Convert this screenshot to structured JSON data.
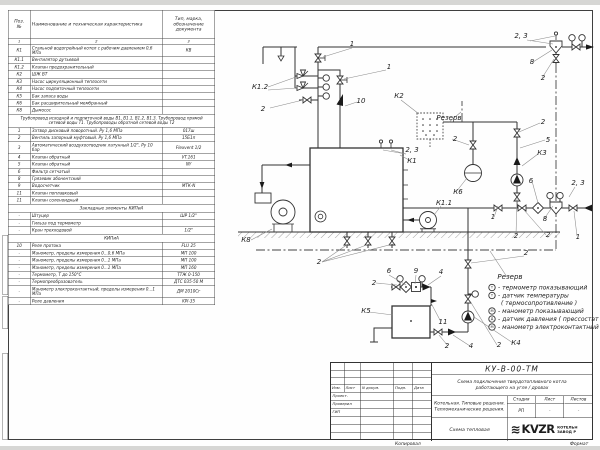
{
  "spec_table": {
    "headers": {
      "pos": "Поз.\n№",
      "name": "Наименование и техническая характеристика",
      "type": "Тип, марка, обозначение документа"
    },
    "col_nums": [
      "1",
      "2",
      "3"
    ],
    "rows": [
      {
        "pos": "К1",
        "name": "Стальной водогрейный котел с рабочим давлением 0,6 МПа",
        "type": "КВ"
      },
      {
        "pos": "К1.1",
        "name": "Вентилятор дутьевой",
        "type": ""
      },
      {
        "pos": "К1.2",
        "name": "Клапан предохранительный",
        "type": ""
      },
      {
        "pos": "К2",
        "name": "ШЖ ВТ",
        "type": ""
      },
      {
        "pos": "К3",
        "name": "Насос циркуляционный теплосети",
        "type": ""
      },
      {
        "pos": "К4",
        "name": "Насос подпиточный теплосети",
        "type": ""
      },
      {
        "pos": "К5",
        "name": "Бак запаса воды",
        "type": ""
      },
      {
        "pos": "К6",
        "name": "Бак расширительный мембранный",
        "type": ""
      },
      {
        "pos": "К8",
        "name": "Дымосос",
        "type": ""
      },
      {
        "span": "Трубопровод исходной и подпиточной воды В1, В1.1, В1.2, В1.3. Трубопровод прямой сетевой воды Т1. Трубопроводы обратной сетевой воды Т2"
      },
      {
        "pos": "1",
        "name": "Затвор дисковый поворотный. Ру 1,6 МПа",
        "type": "017ш"
      },
      {
        "pos": "2",
        "name": "Вентиль запорный муфтовый. Ру 1,6 МПа",
        "type": "15Б1п"
      },
      {
        "pos": "3",
        "name": "Автоматический воздухоотводчик латунный 1/2\", Ру 10 бар",
        "type": "Flexvent 1/2"
      },
      {
        "pos": "4",
        "name": "Клапан обратный",
        "type": "VT.161"
      },
      {
        "pos": "5",
        "name": "Клапан обратный",
        "type": "NY"
      },
      {
        "pos": "6",
        "name": "Фильтр сетчатый",
        "type": ""
      },
      {
        "pos": "8",
        "name": "Грязевик абонентский",
        "type": ""
      },
      {
        "pos": "9",
        "name": "Водосчетчик",
        "type": "МТК-N"
      },
      {
        "pos": "11",
        "name": "Клапан поплавковый",
        "type": ""
      },
      {
        "pos": "11",
        "name": "Клапан соленоидный",
        "type": ""
      },
      {
        "section": "Закладные элементы КИПиА"
      },
      {
        "pos": "-",
        "name": "Штуцер",
        "type": "ШР 1/2\""
      },
      {
        "pos": "-",
        "name": "Гильза под термометр",
        "type": ""
      },
      {
        "pos": "-",
        "name": "Кран трехходовой",
        "type": "1/2\""
      },
      {
        "section": "КИПиА"
      },
      {
        "pos": "10",
        "name": "Реле протока",
        "type": "FLU 25"
      },
      {
        "pos": "-",
        "name": "Манометр, пределы измерения 0...0,6 МПа",
        "type": "МП 100"
      },
      {
        "pos": "-",
        "name": "Манометр, пределы измерения 0...1 МПа",
        "type": "МП 100"
      },
      {
        "pos": "-",
        "name": "Манометр, пределы измерения 0...1 МПа",
        "type": "МП 160"
      },
      {
        "pos": "-",
        "name": "Термометр, Т до 150°С",
        "type": "ТТЖ 0-150"
      },
      {
        "pos": "-",
        "name": "Термопреобразователь",
        "type": "ДТС 035-50 М"
      },
      {
        "pos": "-",
        "name": "Манометр электроконтактный, пределы измерения 0...1 МПа",
        "type": "ДМ 2010Сг"
      },
      {
        "pos": "-",
        "name": "Реле давления",
        "type": "KPI-35"
      }
    ]
  },
  "schematic": {
    "labels": [
      {
        "t": "1",
        "x": 352,
        "y": 46
      },
      {
        "t": "1",
        "x": 389,
        "y": 69
      },
      {
        "t": "К1.2",
        "x": 260,
        "y": 89
      },
      {
        "t": "2",
        "x": 263,
        "y": 111
      },
      {
        "t": "10",
        "x": 361,
        "y": 103
      },
      {
        "t": "К2",
        "x": 399,
        "y": 98
      },
      {
        "t": "Резерв",
        "x": 449,
        "y": 120
      },
      {
        "t": "2",
        "x": 455,
        "y": 141
      },
      {
        "t": "К6",
        "x": 458,
        "y": 194
      },
      {
        "t": "К1.1",
        "x": 444,
        "y": 205
      },
      {
        "t": "2, 3",
        "x": 412,
        "y": 152
      },
      {
        "t": "К1",
        "x": 412,
        "y": 163
      },
      {
        "t": "2, 3",
        "x": 521,
        "y": 38
      },
      {
        "t": "8",
        "x": 532,
        "y": 64
      },
      {
        "t": "2",
        "x": 543,
        "y": 80
      },
      {
        "t": "2",
        "x": 543,
        "y": 124
      },
      {
        "t": "5",
        "x": 548,
        "y": 142
      },
      {
        "t": "К3",
        "x": 542,
        "y": 155
      },
      {
        "t": "6",
        "x": 531,
        "y": 183
      },
      {
        "t": "2, 3",
        "x": 578,
        "y": 185
      },
      {
        "t": "1",
        "x": 493,
        "y": 219
      },
      {
        "t": "8",
        "x": 545,
        "y": 221
      },
      {
        "t": "2",
        "x": 516,
        "y": 238
      },
      {
        "t": "2",
        "x": 548,
        "y": 237
      },
      {
        "t": "1",
        "x": 578,
        "y": 239
      },
      {
        "t": "К8",
        "x": 246,
        "y": 242
      },
      {
        "t": "2",
        "x": 319,
        "y": 264
      },
      {
        "t": "6",
        "x": 389,
        "y": 273
      },
      {
        "t": "2",
        "x": 374,
        "y": 285
      },
      {
        "t": "9",
        "x": 416,
        "y": 273
      },
      {
        "t": "4",
        "x": 441,
        "y": 274
      },
      {
        "t": "Резерв",
        "x": 510,
        "y": 279
      },
      {
        "t": "2",
        "x": 526,
        "y": 255
      },
      {
        "t": "К5",
        "x": 366,
        "y": 313
      },
      {
        "t": "11",
        "x": 443,
        "y": 324
      },
      {
        "t": "2",
        "x": 447,
        "y": 348
      },
      {
        "t": "4",
        "x": 471,
        "y": 348
      },
      {
        "t": "2",
        "x": 499,
        "y": 347
      },
      {
        "t": "К4",
        "x": 516,
        "y": 345
      }
    ],
    "legend": {
      "items": [
        {
          "sym": "Т",
          "text": "- термометр показывающий"
        },
        {
          "sym": "Т",
          "text": "- датчик температуры",
          "text2": "( термосопротивление )"
        },
        {
          "sym": "М",
          "text": "- манометр показывающий"
        },
        {
          "sym": "Д",
          "text": "- датчик давления ( прессостат )"
        },
        {
          "sym": "М",
          "text": "- манометр электроконтактный"
        }
      ]
    }
  },
  "title_block": {
    "doc_code": "КУ-В-00-ТМ",
    "subtitle": "Схема подключения твердотопливного котла работающего на угле / дровах",
    "project": "Котельная. Типовые решения.\nТепломеханические решения.",
    "stage_label": "Стадия",
    "sheet_label": "Лист",
    "sheets_label": "Листов",
    "stage_value": "РП",
    "sheet_value": "-",
    "sheets_value": "-",
    "scheme_name": "Схема тепловая",
    "logo_word": "KVZR",
    "logo_caption_line1": "КОТЕЛЬН",
    "logo_caption_line2": "ЗАВОД Р",
    "rev_headers": {
      "izm": "Изм.",
      "list": "Лист",
      "ndoc": "N докум.",
      "podp": "Подп.",
      "data": "Дата"
    },
    "roles": {
      "r1": "Проект.",
      "r2": "Проверил",
      "r3": "ГИП"
    }
  },
  "footer": {
    "copied": "Копировал",
    "format": "Формат"
  }
}
